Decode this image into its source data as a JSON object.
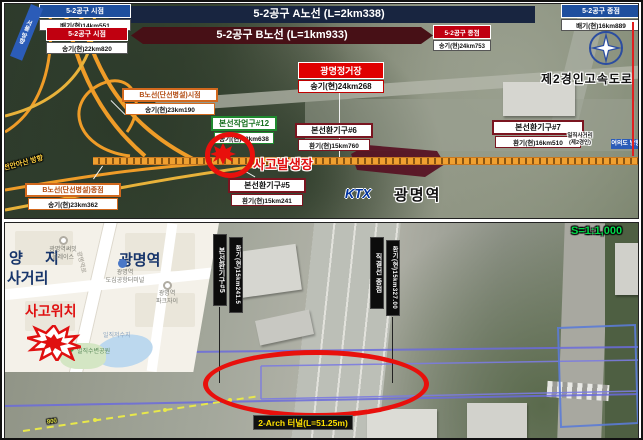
{
  "top_panel": {
    "banner_a": "5-2공구 A노선 (L=2km338)",
    "banner_b": "5-2공구 B노선 (L=1km933)",
    "start_a_title": "5-2공구 시점",
    "start_a_value": "배기(현)14km551",
    "end_a_title": "5-2공구 종점",
    "end_a_value": "배기(현)16km889",
    "start_b_title": "5-2공구 시점",
    "start_b_value": "송기(현)22km820",
    "end_b_title": "5-2공구 종점",
    "end_b_value": "송기(현)24km753",
    "station_title": "광명정거장",
    "station_value": "송기(현)24km268",
    "b_start_title": "B노선(단선병설)시점",
    "b_start_value": "송기(현)23km190",
    "b_end_title": "B노선(단선병설)종점",
    "b_end_value": "송기(현)23km362",
    "shaft12_title": "본선작업구#12",
    "shaft12_value": "송기(현)23km638",
    "vent5_title": "본선환기구#5",
    "vent5_value": "환기(현)15km241",
    "vent6_title": "본선환기구#6",
    "vent6_value": "환기(현)15km760",
    "vent7_title": "본선환기구#7",
    "vent7_value": "환기(현)16km510",
    "accident_label": "사고발생장",
    "highway_label": "제2경인고속도로",
    "road_caption1": "일직사거리",
    "road_caption2": "(제2경인)",
    "ktx_logo": "KTX",
    "station_name": "광명역",
    "dir_left": "천안아산 방향",
    "dir_right": "여의도 방향",
    "dir_top": "서울 방향"
  },
  "bottom_panel": {
    "yangji1": "양  지",
    "yangji2": "사거리",
    "station_big": "광명역",
    "summit1": "광명역써밋",
    "summit2": "플레이스",
    "terminal1": "광명역",
    "terminal2": "도심공항터미널",
    "parkxi1": "광명역",
    "parkxi2": "파크자이",
    "accident_label": "사고위치",
    "reservoir": "일직저수지",
    "waterside_park": "일직수변공원",
    "road_name": "광명역로",
    "vent5_title": "본선환기구#5",
    "vent5_value": "환기(현)15km241.5",
    "junction_title": "직결선 종점",
    "junction_value": "환기(현)15km327.00",
    "tunnel_label": "2-Arch 터널(L=51.25m)",
    "scale_label": "S=1:1,000",
    "chainage_tick": "800"
  },
  "colors": {
    "accent_red": "#e8100c",
    "banner_navy": "#182540",
    "banner_maroon": "#471016",
    "flag_blue": "#1e4f9e",
    "flag_red": "#c00010",
    "scale_green": "#00d848",
    "rail_orange": "#f0a030",
    "survey_purple": "#6b6bdc",
    "tunnel_yellow": "#ffe000"
  }
}
